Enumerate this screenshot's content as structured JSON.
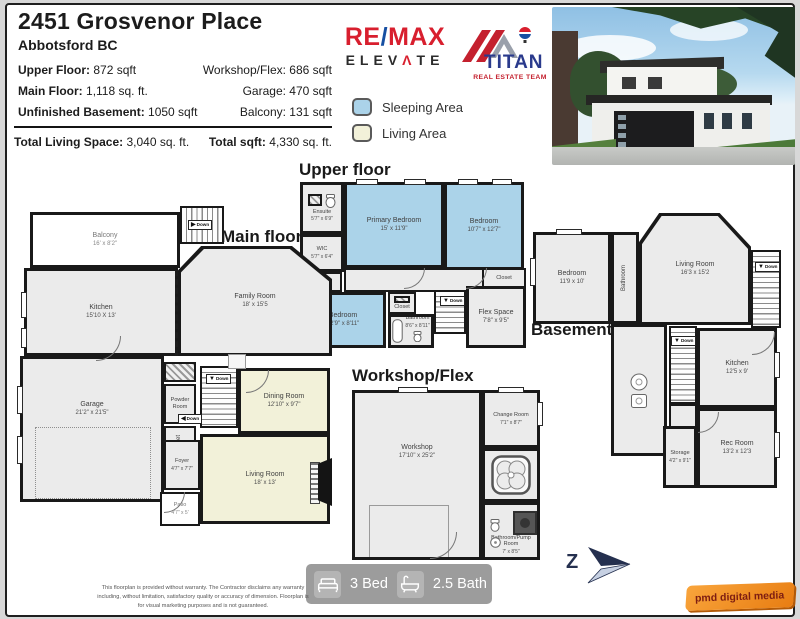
{
  "page": {
    "title": "2451 Grosvenor Place",
    "subtitle": "Abbotsford BC"
  },
  "stats": {
    "left": [
      {
        "label": "Upper Floor:",
        "value": "872 sqft"
      },
      {
        "label": "Main Floor:",
        "value": "1,118 sq. ft."
      },
      {
        "label": "Unfinished Basement:",
        "value": "1050 sqft"
      }
    ],
    "right": [
      {
        "label": "Workshop/Flex:",
        "value": "686 sqft"
      },
      {
        "label": "Garage:",
        "value": "470 sqft"
      },
      {
        "label": "Balcony:",
        "value": "131 sqft"
      }
    ],
    "totals": [
      {
        "label": "Total Living Space:",
        "value": "3,040 sq. ft."
      },
      {
        "label": "Total sqft:",
        "value": "4,330 sq. ft."
      }
    ]
  },
  "branding": {
    "remax": {
      "re": "RE",
      "slash": "/",
      "max": "MAX",
      "elevate_pre": "ELEV",
      "caret": "Λ",
      "elevate_post": "TE"
    },
    "titan": {
      "name": "TITAN",
      "tagline": "REAL ESTATE TEAM"
    }
  },
  "colors": {
    "remax_red": "#d81f2e",
    "remax_blue": "#164fa2",
    "titan_blue": "#2a3a8c",
    "titan_red": "#c4202e",
    "sleeping": "#abd3e9",
    "living": "#f2f1d9",
    "compass_navy": "#25304f"
  },
  "legend": {
    "items": [
      {
        "label": "Sleeping Area",
        "color": "#abd3e9"
      },
      {
        "label": "Living Area",
        "color": "#f2f1d9"
      }
    ]
  },
  "labels": {
    "closet": "Closet",
    "down": "Down"
  },
  "floors": {
    "upper": {
      "title": "Upper floor",
      "rooms": [
        {
          "name": "Ensuite",
          "dims": "5'7\" x 6'9\""
        },
        {
          "name": "Primary Bedroom",
          "dims": "15' x 11'9\""
        },
        {
          "name": "Bedroom",
          "dims": "10'7\" x 12'7\""
        },
        {
          "name": "WIC",
          "dims": "5'7\" x 6'4\""
        },
        {
          "name": "Bedroom",
          "dims": "12'9\" x 8'11\""
        },
        {
          "name": "Bathroom",
          "dims": "8'6\" x 8'11\""
        },
        {
          "name": "Flex Space",
          "dims": "7'8\" x 9'5\""
        }
      ]
    },
    "main": {
      "title": "Main floor",
      "rooms": [
        {
          "name": "Balcony",
          "dims": "16' x 8'2\""
        },
        {
          "name": "Kitchen",
          "dims": "15'10 X 13'"
        },
        {
          "name": "Family Room",
          "dims": "18' x 15'5"
        },
        {
          "name": "Garage",
          "dims": "21'2\" x 21'5\""
        },
        {
          "name": "Powder Room",
          "dims": ""
        },
        {
          "name": "Dining Room",
          "dims": "12'10\" x 9'7\""
        },
        {
          "name": "Living Room",
          "dims": "18' x 13'"
        },
        {
          "name": "Foyer",
          "dims": "4'7\" x 7'7\""
        },
        {
          "name": "Patio",
          "dims": "4'7\" x 5'"
        }
      ]
    },
    "basement": {
      "title": "Basement",
      "rooms": [
        {
          "name": "Bedroom",
          "dims": "11'9 x 10'"
        },
        {
          "name": "Bathroom",
          "dims": ""
        },
        {
          "name": "Living Room",
          "dims": "16'3 x 15'2"
        },
        {
          "name": "Kitchen",
          "dims": "12'5 x 9'"
        },
        {
          "name": "Storage",
          "dims": "4'2\" x 9'1\""
        },
        {
          "name": "Rec Room",
          "dims": "13'2 x 12'3"
        }
      ]
    },
    "workshop": {
      "title": "Workshop/Flex",
      "rooms": [
        {
          "name": "Workshop",
          "dims": "17'10\" x 25'2\""
        },
        {
          "name": "Change Room",
          "dims": "7'1\" x 8'7\""
        },
        {
          "name": "Bathroom/Pump Room",
          "dims": "7' x 8'5\""
        }
      ]
    }
  },
  "footer": {
    "beds": "3 Bed",
    "baths": "2.5 Bath",
    "compass_letter": "Z",
    "credit": "pmd digital media",
    "disclaimer_lines": [
      "This floorplan is provided without warranty. The Contractor disclaims any warranty",
      "including, without limitation, satisfactory quality or accuracy of dimension. Floorplan is",
      "for visual marketing purposes and is not guaranteed."
    ]
  }
}
